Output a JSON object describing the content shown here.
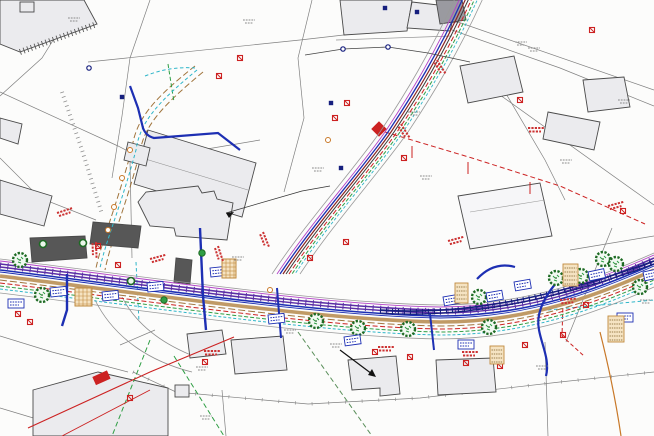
{
  "drawing": {
    "kind": "utility-services-site-plan",
    "canvas": {
      "width": 654,
      "height": 436
    }
  },
  "colors": {
    "paper": "#fcfcfb",
    "parcel": "#6b6b6b",
    "parcel-light": "#8f8f8f",
    "building-fill": "#ebebee",
    "building-stroke": "#4a4a4a",
    "building-dark": "#575757",
    "duct-purple": "#5b2ea6",
    "magenta": "#b344c8",
    "water-blue": "#1d2fb3",
    "navy": "#161f7e",
    "road-brown": "#c09a66",
    "track-brown": "#a0743c",
    "power-red": "#cc2222",
    "dark-red": "#8a2424",
    "drain-green": "#2f9e44",
    "tree-green": "#1e6b24",
    "comms-cyan": "#2fb6c9",
    "orange": "#c87828",
    "tan-fill": "#f5e3c2",
    "tan-stroke": "#c08a3e",
    "text-gray": "#8a8a8a",
    "text-red": "#cc3333"
  },
  "road": {
    "offsets": [
      {
        "dy": -13,
        "color": "#9a9a9a",
        "w": 0.8,
        "dash": ""
      },
      {
        "dy": -11,
        "color": "#b344c8",
        "w": 0.9,
        "dash": ""
      },
      {
        "dy": -8,
        "color": "#5b2ea6",
        "w": 1.6,
        "dash": ""
      },
      {
        "dy": -5,
        "color": "#5b2ea6",
        "w": 1.4,
        "dash": ""
      },
      {
        "dy": -6.5,
        "color": "#5b2ea6",
        "w": 6.5,
        "dash": "1 6.5"
      },
      {
        "dy": -2,
        "color": "#1d2fb3",
        "w": 1.6,
        "dash": ""
      },
      {
        "dy": 0,
        "color": "#1d2fb3",
        "w": 0.9,
        "dash": ""
      },
      {
        "dy": 4,
        "color": "#c09a66",
        "w": 3.6,
        "dash": ""
      },
      {
        "dy": 8,
        "color": "#a0743c",
        "w": 1.0,
        "dash": "7 3"
      },
      {
        "dy": 11,
        "color": "#cc2222",
        "w": 1.0,
        "dash": "5 2.5"
      },
      {
        "dy": 14,
        "color": "#2f9e44",
        "w": 1.0,
        "dash": "4 2"
      },
      {
        "dy": 17,
        "color": "#2fb6c9",
        "w": 1.0,
        "dash": "3 2"
      },
      {
        "dy": 21,
        "color": "#9a9a9a",
        "w": 0.8,
        "dash": ""
      }
    ]
  },
  "corridor": {
    "offsets": [
      {
        "dx": -14,
        "color": "#9a9a9a",
        "w": 0.8,
        "dash": ""
      },
      {
        "dx": -9,
        "color": "#b344c8",
        "w": 0.9,
        "dash": ""
      },
      {
        "dx": -6,
        "color": "#1d2fb3",
        "w": 1.3,
        "dash": ""
      },
      {
        "dx": -3,
        "color": "#8a2424",
        "w": 1.2,
        "dash": ""
      },
      {
        "dx": 0,
        "color": "#3a3a3a",
        "w": 1.0,
        "dash": ""
      },
      {
        "dx": 3,
        "color": "#cc2222",
        "w": 1.0,
        "dash": "5 2.5"
      },
      {
        "dx": 6,
        "color": "#2f9e44",
        "w": 1.0,
        "dash": "4 2"
      },
      {
        "dx": 9,
        "color": "#2fb6c9",
        "w": 0.9,
        "dash": "3 2"
      },
      {
        "dx": 14,
        "color": "#9a9a9a",
        "w": 0.8,
        "dash": ""
      }
    ]
  },
  "symbols": {
    "trees": [
      [
        20,
        260
      ],
      [
        42,
        295
      ],
      [
        316,
        321
      ],
      [
        358,
        328
      ],
      [
        408,
        329
      ],
      [
        479,
        297
      ],
      [
        489,
        327
      ],
      [
        556,
        278
      ],
      [
        581,
        276
      ],
      [
        603,
        259
      ],
      [
        616,
        264
      ],
      [
        640,
        287
      ]
    ],
    "shrubs": [
      [
        202,
        253
      ],
      [
        164,
        300
      ]
    ],
    "green_rings": [
      [
        43,
        244
      ],
      [
        83,
        243
      ],
      [
        131,
        281
      ]
    ],
    "red_markers": [
      [
        240,
        58
      ],
      [
        219,
        76
      ],
      [
        347,
        103
      ],
      [
        335,
        118
      ],
      [
        592,
        30
      ],
      [
        520,
        100
      ],
      [
        18,
        314
      ],
      [
        30,
        322
      ],
      [
        130,
        398
      ],
      [
        205,
        362
      ],
      [
        375,
        352
      ],
      [
        410,
        357
      ],
      [
        466,
        363
      ],
      [
        500,
        366
      ],
      [
        525,
        345
      ],
      [
        563,
        335
      ],
      [
        586,
        305
      ],
      [
        623,
        211
      ],
      [
        404,
        158
      ],
      [
        310,
        258
      ],
      [
        346,
        242
      ],
      [
        98,
        246
      ],
      [
        118,
        265
      ]
    ],
    "navy_squares": [
      [
        122,
        97
      ],
      [
        385,
        8
      ],
      [
        417,
        12
      ],
      [
        331,
        103
      ],
      [
        341,
        168
      ]
    ],
    "navy_circles": [
      [
        89,
        68
      ],
      [
        343,
        49
      ],
      [
        388,
        47
      ]
    ],
    "orange_rings": [
      [
        130,
        150
      ],
      [
        122,
        178
      ],
      [
        114,
        207
      ],
      [
        108,
        230
      ],
      [
        328,
        140
      ],
      [
        270,
        290
      ]
    ],
    "blue_labels": [
      [
        8,
        299,
        0
      ],
      [
        50,
        288,
        -6
      ],
      [
        102,
        292,
        -6
      ],
      [
        147,
        283,
        -6
      ],
      [
        210,
        268,
        -6
      ],
      [
        268,
        315,
        -6
      ],
      [
        344,
        337,
        -8
      ],
      [
        443,
        297,
        -10
      ],
      [
        486,
        293,
        -10
      ],
      [
        514,
        282,
        -10
      ],
      [
        588,
        272,
        -12
      ],
      [
        643,
        272,
        -12
      ],
      [
        617,
        313,
        0
      ],
      [
        458,
        340,
        0
      ]
    ],
    "tan_tables": [
      [
        563,
        264,
        15,
        22
      ],
      [
        455,
        283,
        13,
        20
      ],
      [
        608,
        316,
        16,
        26
      ],
      [
        490,
        346,
        14,
        18
      ]
    ],
    "hatch_squares": [
      [
        75,
        288,
        17,
        18
      ],
      [
        222,
        259,
        14,
        19
      ]
    ],
    "red_texts": [
      [
        57,
        213,
        -18
      ],
      [
        150,
        259,
        -15
      ],
      [
        218,
        246,
        72
      ],
      [
        263,
        232,
        68
      ],
      [
        401,
        124,
        58
      ],
      [
        437,
        60,
        58
      ],
      [
        96,
        242,
        88
      ],
      [
        448,
        241,
        -15
      ],
      [
        560,
        300,
        -5
      ],
      [
        204,
        351,
        0
      ],
      [
        378,
        347,
        0
      ],
      [
        462,
        352,
        0
      ],
      [
        608,
        206,
        -15
      ],
      [
        528,
        128,
        0
      ]
    ],
    "gray_texts": [
      [
        243,
        20
      ],
      [
        312,
        168
      ],
      [
        408,
        112
      ],
      [
        420,
        176
      ],
      [
        232,
        257
      ],
      [
        196,
        367
      ],
      [
        330,
        344
      ],
      [
        528,
        48
      ],
      [
        560,
        160
      ],
      [
        618,
        100
      ],
      [
        200,
        416
      ],
      [
        536,
        366
      ],
      [
        640,
        300
      ],
      [
        68,
        18
      ],
      [
        284,
        330
      ],
      [
        515,
        42
      ]
    ]
  }
}
